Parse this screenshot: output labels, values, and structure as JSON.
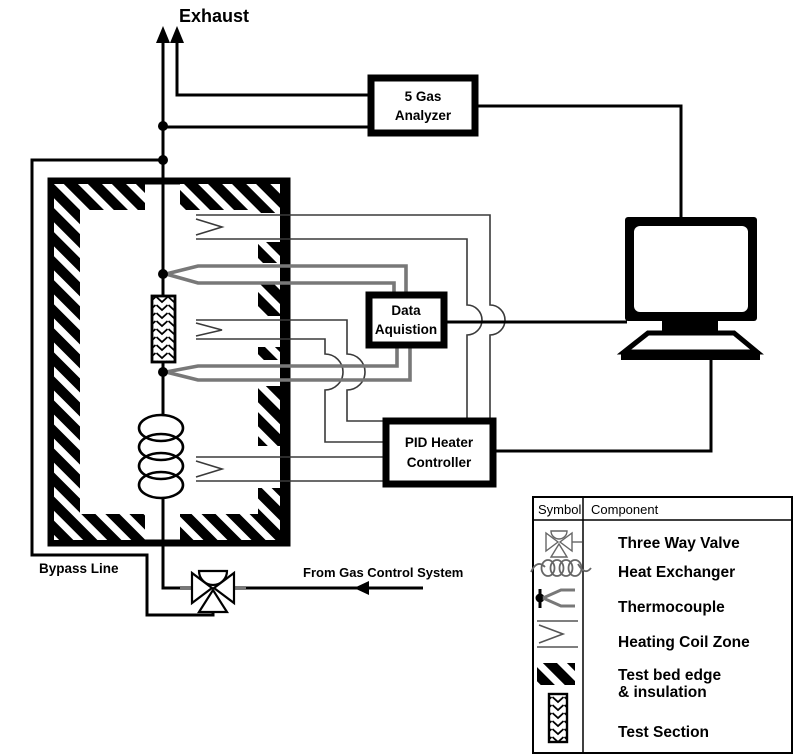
{
  "labels": {
    "exhaust": "Exhaust",
    "bypass_line": "Bypass Line",
    "from_gas_control": "From Gas Control System"
  },
  "boxes": {
    "gas_analyzer": {
      "line1": "5 Gas",
      "line2": "Analyzer"
    },
    "data_acquisition": {
      "line1": "Data",
      "line2": "Aquistion"
    },
    "pid_controller": {
      "line1": "PID Heater",
      "line2": "Controller"
    }
  },
  "legend": {
    "header": {
      "symbol": "Symbol",
      "component": "Component"
    },
    "rows": [
      {
        "icon": "three-way-valve-icon",
        "label": "Three Way Valve"
      },
      {
        "icon": "heat-exchanger-icon",
        "label": "Heat Exchanger"
      },
      {
        "icon": "thermocouple-icon",
        "label": "Thermocouple"
      },
      {
        "icon": "heating-coil-zone-icon",
        "label": "Heating Coil Zone"
      },
      {
        "icon": "test-bed-edge-icon",
        "label": "Test bed edge",
        "label2": "& insulation"
      },
      {
        "icon": "test-section-icon",
        "label": "Test Section"
      }
    ]
  },
  "colors": {
    "line": "#000000",
    "wire_gray": "#787878",
    "background": "#ffffff"
  }
}
